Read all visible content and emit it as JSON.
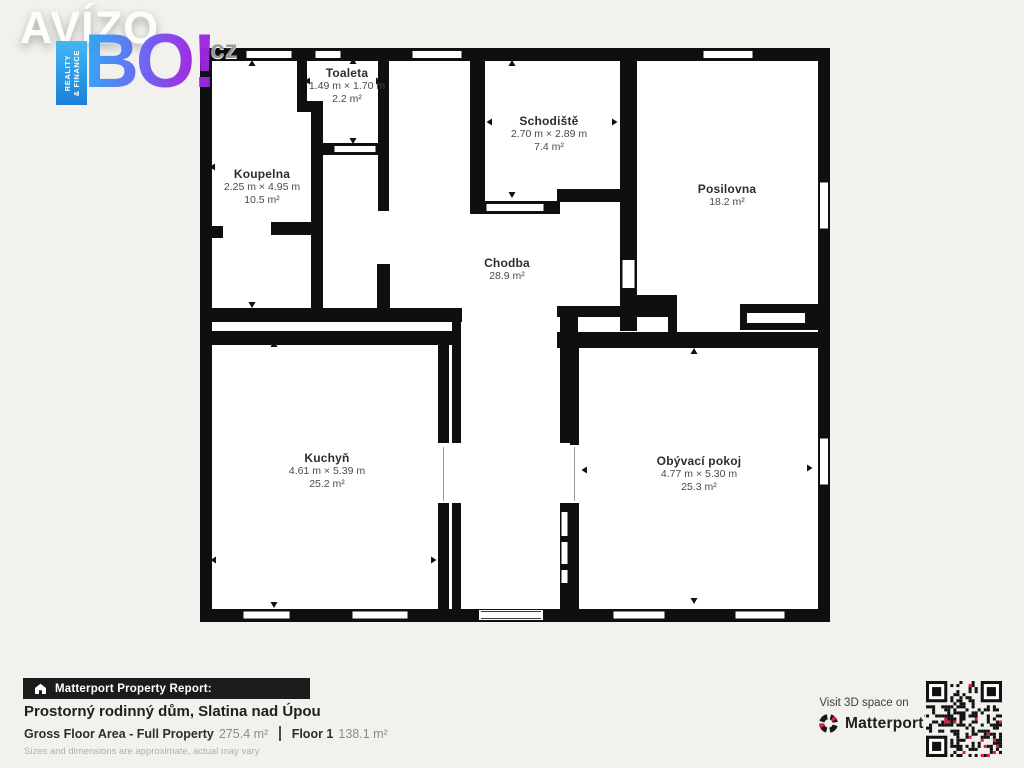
{
  "logo": {
    "brand": "AVÍZO",
    "tld": ".cz",
    "tagline": "BO!",
    "ribbon_line1": "REALITY",
    "ribbon_line2": "& FINANCE"
  },
  "floorplan": {
    "rooms": [
      {
        "name": "Toaleta",
        "dims": "1.49 m × 1.70 m",
        "area": "2.2 m²"
      },
      {
        "name": "Koupelna",
        "dims": "2.25 m × 4.95 m",
        "area": "10.5 m²"
      },
      {
        "name": "Schodiště",
        "dims": "2.70 m × 2.89 m",
        "area": "7.4 m²"
      },
      {
        "name": "Posilovna",
        "dims": "",
        "area": "18.2 m²"
      },
      {
        "name": "Chodba",
        "dims": "",
        "area": "28.9 m²"
      },
      {
        "name": "Kuchyň",
        "dims": "4.61 m × 5.39 m",
        "area": "25.2 m²"
      },
      {
        "name": "Obývací pokoj",
        "dims": "4.77 m × 5.30 m",
        "area": "25.3 m²"
      }
    ]
  },
  "footer": {
    "report_label": "Matterport Property Report:",
    "property_title": "Prostorný rodinný dům, Slatina nad Úpou",
    "gfa_label": "Gross Floor Area - Full Property",
    "gfa_value": "275.4 m²",
    "floor_label": "Floor 1",
    "floor_value": "138.1 m²",
    "disclaimer": "Sizes and dimensions are approximate, actual may vary"
  },
  "cta": {
    "visit_label": "Visit 3D space on",
    "brand": "Matterport"
  },
  "colors": {
    "wall": "#0f0f0f",
    "background": "#f2f1ee",
    "matterport_red": "#dd1d41",
    "avizo_blue": "#2fa3f5",
    "avizo_purple": "#9c27e0"
  }
}
